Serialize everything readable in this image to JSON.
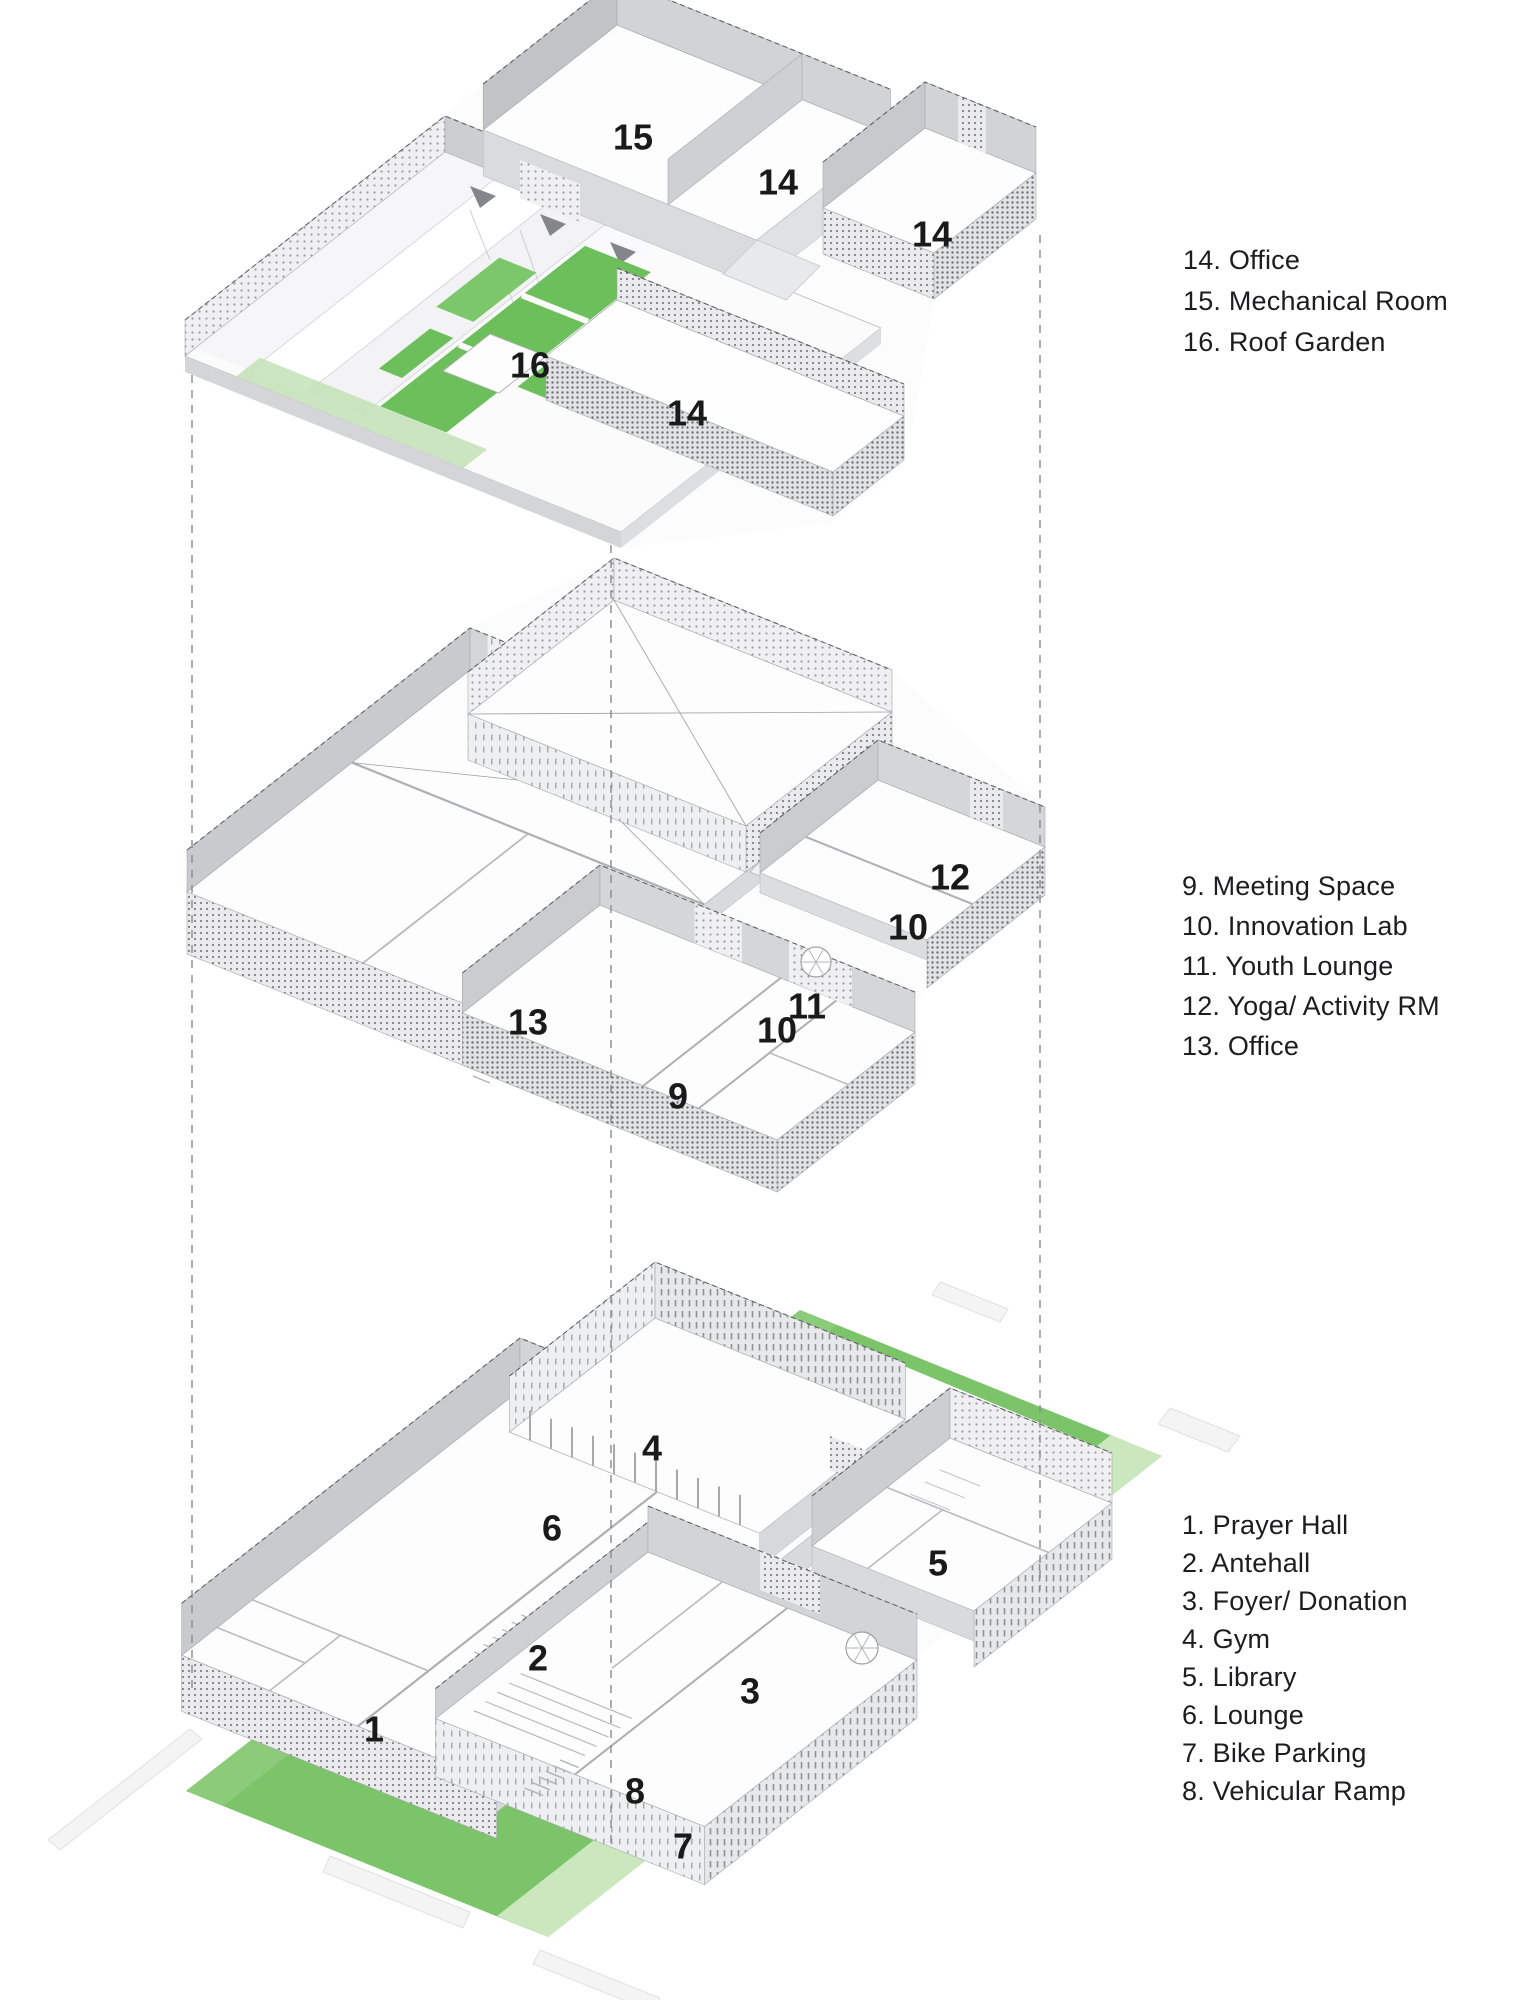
{
  "diagram": {
    "type": "exploded-axonometric-floor-plan",
    "background": "#ffffff",
    "colors": {
      "roof_garden_green": "#6dbf5c",
      "site_green": "#7cc46a",
      "site_walkway_light_green": "#cbe7bd",
      "site_edge_green": "#93cf82",
      "label_text": "#1a1a1b",
      "legend_text": "#1d1d1f",
      "dashed_projection_line": "#8a8a8c",
      "wall_gray": "#c9cacd"
    },
    "levels": [
      {
        "plan_labels": [
          {
            "text": "15"
          },
          {
            "text": "14"
          },
          {
            "text": "14"
          },
          {
            "text": "16"
          },
          {
            "text": "14"
          }
        ]
      },
      {
        "plan_labels": [
          {
            "text": "12"
          },
          {
            "text": "10"
          },
          {
            "text": "11"
          },
          {
            "text": "10"
          },
          {
            "text": "13"
          },
          {
            "text": "9"
          }
        ]
      },
      {
        "plan_labels": [
          {
            "text": "4"
          },
          {
            "text": "6"
          },
          {
            "text": "5"
          },
          {
            "text": "2"
          },
          {
            "text": "3"
          },
          {
            "text": "1"
          },
          {
            "text": "8"
          },
          {
            "text": "7"
          }
        ]
      }
    ],
    "legends": [
      {
        "items": [
          {
            "text": "14. Office"
          },
          {
            "text": "15. Mechanical Room"
          },
          {
            "text": "16. Roof Garden"
          }
        ]
      },
      {
        "items": [
          {
            "text": "9. Meeting Space"
          },
          {
            "text": "10. Innovation Lab"
          },
          {
            "text": "11. Youth Lounge"
          },
          {
            "text": "12. Yoga/ Activity RM"
          },
          {
            "text": "13. Office"
          }
        ]
      },
      {
        "items": [
          {
            "text": "1. Prayer Hall"
          },
          {
            "text": "2. Antehall"
          },
          {
            "text": "3. Foyer/ Donation"
          },
          {
            "text": "4. Gym"
          },
          {
            "text": "5. Library"
          },
          {
            "text": "6. Lounge"
          },
          {
            "text": "7. Bike Parking"
          },
          {
            "text": "8. Vehicular Ramp"
          }
        ]
      }
    ]
  }
}
